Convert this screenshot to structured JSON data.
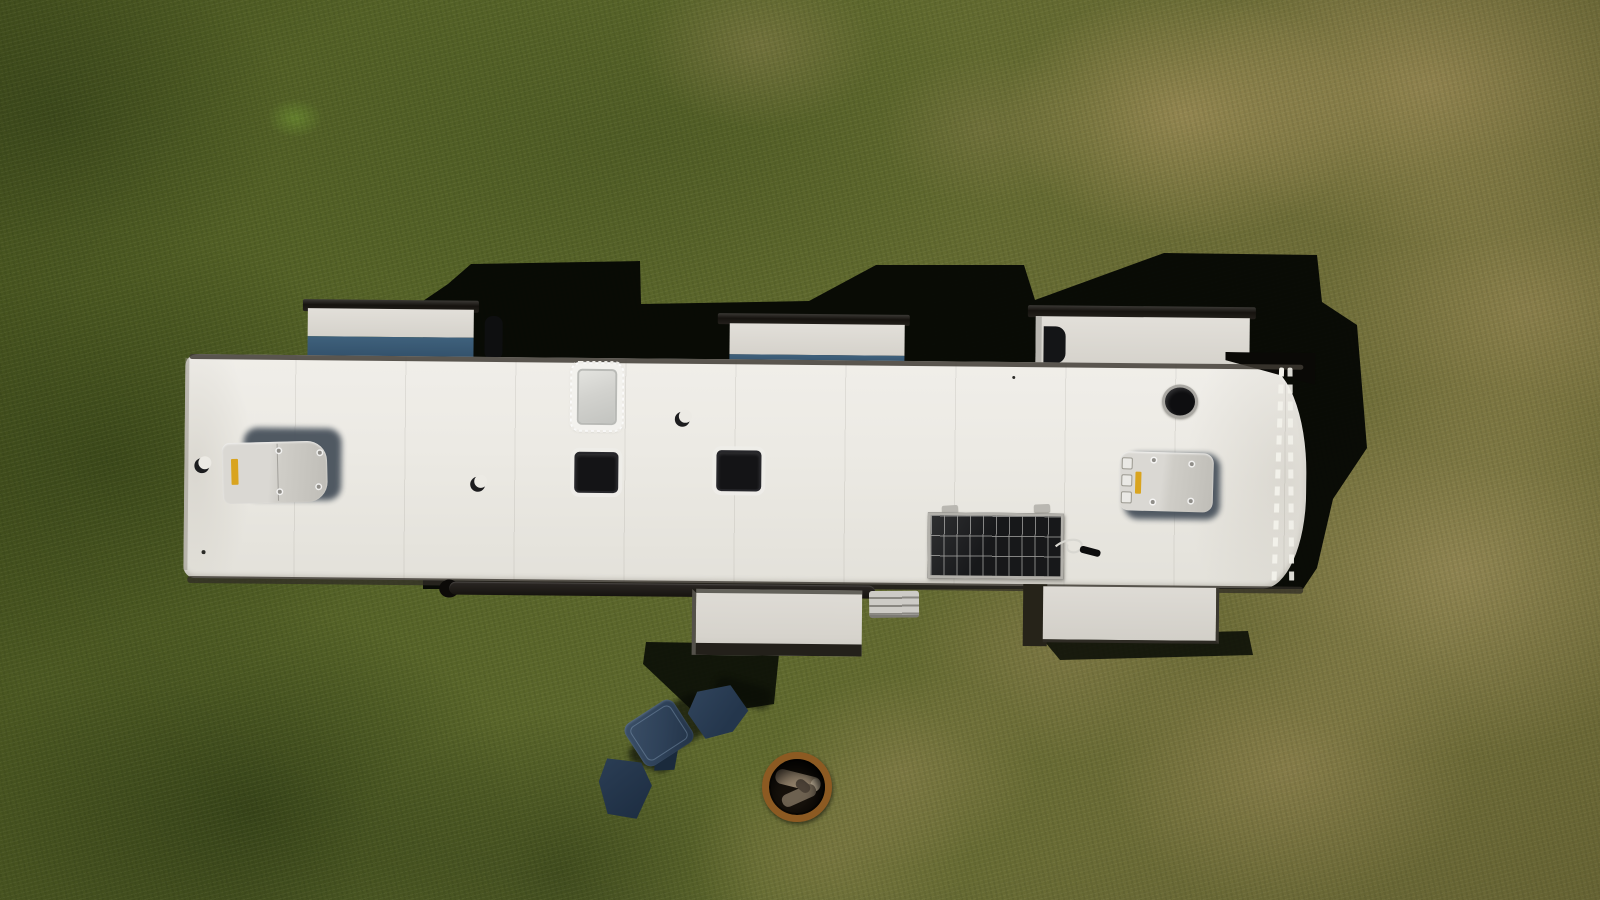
{
  "scene": {
    "description": "Aerial top-down drone photograph of a white travel trailer (RV) roof parked on patchy green and dry grass",
    "time_of_day": "sunny daytime, hard shadows cast toward upper right",
    "objects": [
      {
        "name": "grass-field",
        "label": "patchy grass with dry tan spots"
      },
      {
        "name": "rv-roof",
        "label": "white RV roof with seams"
      },
      {
        "name": "rv-shadow",
        "label": "hard black shadow cast by RV and slide-outs"
      },
      {
        "name": "slide-out-front-left",
        "label": "front-left slide-out with white and blue fascia"
      },
      {
        "name": "slide-out-front-middle",
        "label": "front-middle slide-out with white and blue fascia"
      },
      {
        "name": "slide-out-front-right",
        "label": "front-right slide-out, white with dark grab handle"
      },
      {
        "name": "slide-out-rear-middle",
        "label": "rear-middle slide-out below roof edge"
      },
      {
        "name": "slide-out-rear-right",
        "label": "rear-right slide-out below roof edge"
      },
      {
        "name": "ac-unit-front",
        "label": "rooftop air conditioner shroud with yellow label"
      },
      {
        "name": "ac-unit-rear",
        "label": "second rooftop air conditioner shroud with vent slats"
      },
      {
        "name": "skylight",
        "label": "frosted skylight with sealant border"
      },
      {
        "name": "roof-vent-square-1",
        "label": "dark square roof vent"
      },
      {
        "name": "roof-vent-square-2",
        "label": "dark square roof vent"
      },
      {
        "name": "roof-vent-round",
        "label": "round black plumbing vent"
      },
      {
        "name": "plumbing-cap-1",
        "label": "small crescent vent cap"
      },
      {
        "name": "plumbing-cap-2",
        "label": "small crescent vent cap"
      },
      {
        "name": "plumbing-cap-3",
        "label": "small crescent vent cap"
      },
      {
        "name": "solar-panel",
        "label": "small solar panel with 10x3 cell grid and cable"
      },
      {
        "name": "rear-ladder",
        "label": "rear ladder with white rungs at curved end"
      },
      {
        "name": "awning-roller",
        "label": "dark awning roller bar on lower edge"
      },
      {
        "name": "furnace-vent",
        "label": "small silver wall vent"
      },
      {
        "name": "cooler",
        "label": "navy blue cooler on grass"
      },
      {
        "name": "gear-bag-1",
        "label": "navy camp chair bag"
      },
      {
        "name": "gear-bag-2",
        "label": "navy camp chair bag"
      },
      {
        "name": "fire-pit-ring",
        "label": "rusty steel fire ring with logs"
      }
    ],
    "colors": {
      "shadow": "#070905",
      "roof_white": "#eceae4",
      "slideout_blue": "#3f617c",
      "ac_shadow": "#404a55",
      "sticker_yellow": "#d9a41f",
      "vent_black": "#141416",
      "skylight_frost": "#d2d2ce",
      "solar_cell": "#17181a",
      "solar_frame": "#b2b0aa",
      "ladder_white": "#f2f1ea",
      "cooler_navy": "#2e4158",
      "bag_navy": "#24364c",
      "firepit_rust": "#8c5a22",
      "log_tan": "#9a8a72",
      "grass_green": "#515e26",
      "grass_dry": "#9a8758",
      "grass_dark": "#2a3a12"
    }
  }
}
